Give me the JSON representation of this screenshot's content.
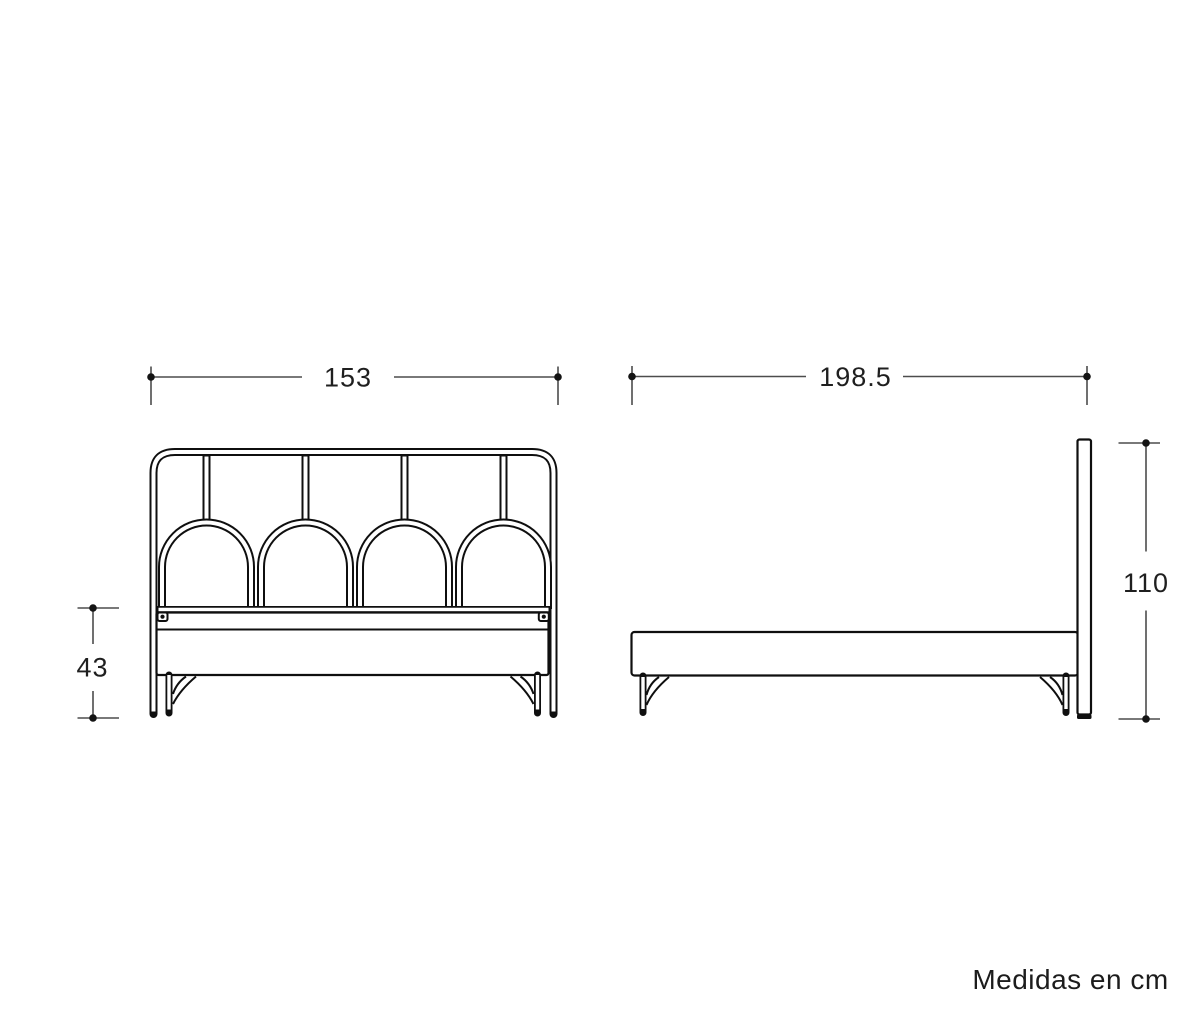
{
  "note": {
    "text": "Medidas en cm"
  },
  "dimensions": {
    "front_width": "153",
    "side_length": "198.5",
    "base_height": "43",
    "headboard_height": "110"
  },
  "colors": {
    "outline": "#0f0f0f",
    "dimension_line": "#4d4d4d",
    "dimension_marker": "#141414",
    "label_text": "#1f1f1f",
    "background": "#ffffff"
  }
}
